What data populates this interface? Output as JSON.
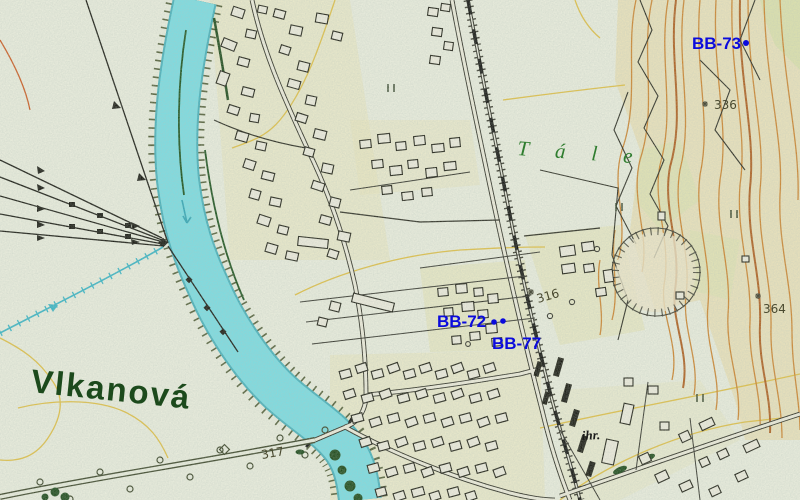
{
  "map": {
    "town_label": "Vlkanová",
    "area_label": "Tále",
    "field_label": "ihr.",
    "boreholes": {
      "bb72": "BB-72",
      "bb77": "BB-77",
      "bb73": "BB-73"
    },
    "elevations": {
      "pt336": "336",
      "pt364": "364",
      "pt316": "316",
      "pt317": "317"
    },
    "colors": {
      "background": "#e9ecdc",
      "river_cyan": "#7cdce1",
      "contour_orange": "#cd8530",
      "contour_index_brown": "#b06020",
      "contour_yellow": "#e0bf45",
      "borehole_blue": "#0b0bdc",
      "town_green": "#1c4a1c",
      "area_green": "#2f7d2f",
      "hill_tint": "#ead9a0",
      "village_tint": "#e9e4b8"
    }
  }
}
